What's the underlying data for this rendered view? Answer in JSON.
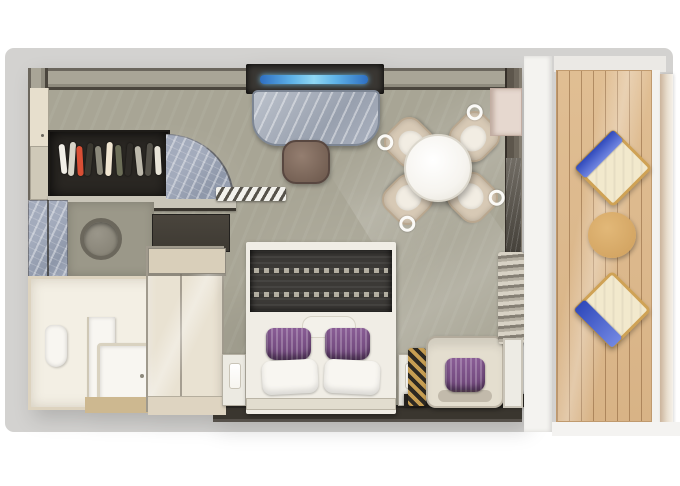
{
  "colors": {
    "page_bg": "#ffffff",
    "canvas_bg": "#d3d2d0",
    "floor": "#a8a595",
    "wall_top_surface": "#a9a597",
    "wall_dark": "#4a453d",
    "wall_edge": "#2e2b26",
    "wall_right": "#5d564c",
    "closet_interior": "#2a2723",
    "threshold": "#c9c5b8",
    "marble_light": "#a3abbc",
    "marble_mid": "#8e97a9",
    "counter": "#9b9889",
    "basin_ring": "#6b675c",
    "dresser": "#3e3a33",
    "bath_wall": "#e7dfcd",
    "bath_inner": "#f3efe4",
    "bath_floor": "#cdb890",
    "fixture_white": "#f8f6f1",
    "glass_bg": "#e9e2d2",
    "glass_frame": "#a09a8d",
    "glass_top": "#d9cfba",
    "bed_white": "#f0ede5",
    "headboard": "#e2ddcf",
    "throw": "#3b3936",
    "throw_stitch": "#d9d4c4",
    "pillow_purple_1": "#8a5d96",
    "pillow_purple_2": "#6a4375",
    "nightstand": "#eceae2",
    "lamp": "#f7f5ef",
    "armchair": "#e4decf",
    "gold": "#c79e52",
    "gold_dark": "#2d2922",
    "rug_dark": "#24211d",
    "desk_recess": "#3a3733",
    "tv_blue_a": "#2e6fc1",
    "tv_blue_b": "#90d7f3",
    "desk_marble_a": "#bcc2cc",
    "desk_marble_b": "#98a0ae",
    "stool_a": "#947e70",
    "stool_b": "#6b574b",
    "table_white": "#f6f4ef",
    "chair_cream": "#d7c9b5",
    "chair_edge": "#b9a78f",
    "cushion_white": "#f2ede3",
    "curtain_a": "#d8d2c5",
    "curtain_b": "#857f74",
    "door_panel": "#edebe4",
    "notch_pink": "#e6d8cf",
    "column_a": "#716c64",
    "column_b": "#45413a",
    "ext_white": "#f4f3f0",
    "deck": "#e0be93",
    "lounger_frame": "#cfa255",
    "lounger_cushion": "#f2e9cd",
    "towel_a": "#2f49bb",
    "towel_b": "#7287e2",
    "side_table_a": "#e2b878",
    "side_table_b": "#cf9f5c",
    "railing_a": "#cbb49c",
    "railing_b": "#f6f2ea"
  },
  "closet": {
    "garment_colors": [
      "#f2efe8",
      "#d8d4c8",
      "#d94f35",
      "#3a372f",
      "#8d8a7c",
      "#f1e6d2",
      "#6c6e58",
      "#2e2b27",
      "#bdb9ac",
      "#55524a",
      "#e8e4d8"
    ]
  },
  "counts": {
    "dining_chairs": 4,
    "balcony_loungers": 2,
    "bed_accent_pillows": 2,
    "bed_white_pillows": 2,
    "armchair_pillows": 1,
    "nightstands": 2,
    "closet_garments": 11
  },
  "objects": {
    "room": [
      "entry-closet",
      "entry-door",
      "vanity-basin",
      "marble-wall-panel",
      "dresser",
      "bathroom",
      "toilet",
      "bathtub",
      "shower",
      "tv",
      "desk",
      "stool",
      "dining-table",
      "dining-chairs",
      "king-bed",
      "nightstands",
      "table-lamps",
      "armchair",
      "luggage-rack",
      "curtains",
      "sliding-door-panel"
    ],
    "balcony": [
      "wood-deck",
      "lounge-chair-top",
      "lounge-chair-bottom",
      "side-table",
      "railing"
    ]
  }
}
